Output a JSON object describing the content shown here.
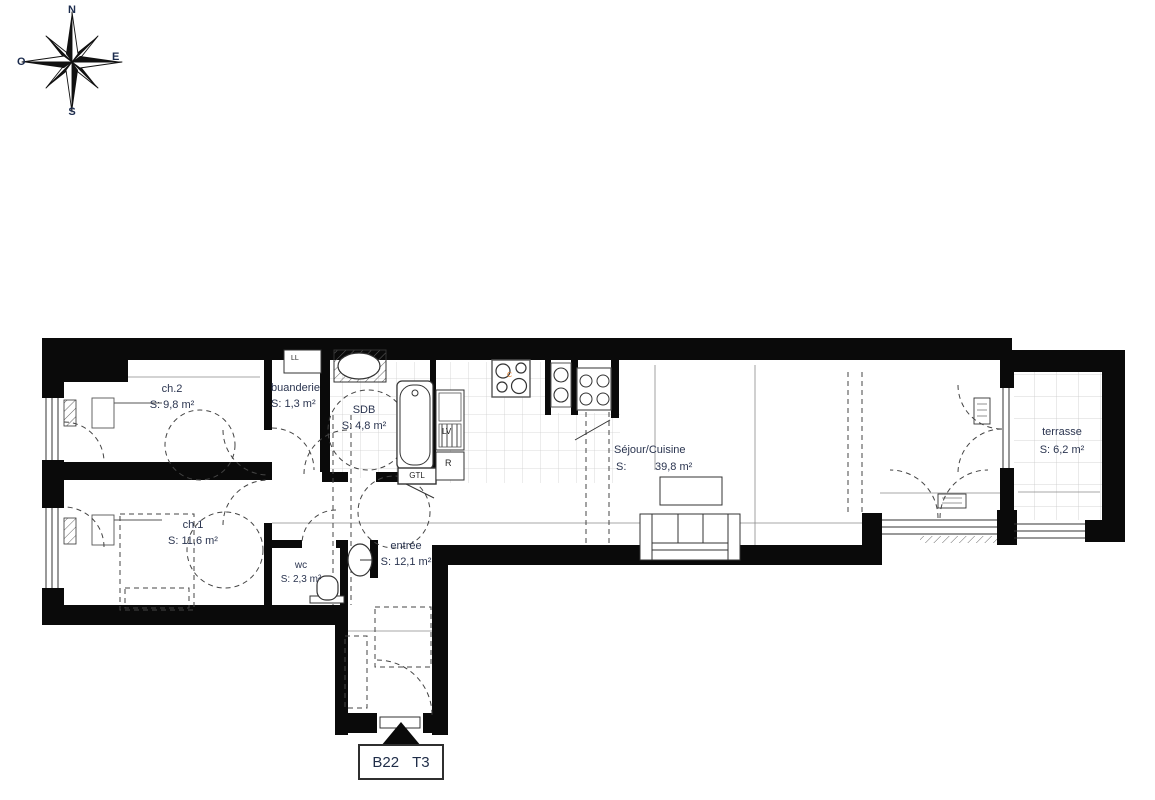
{
  "compass": {
    "north": "N",
    "south": "S",
    "east": "E",
    "west": "O"
  },
  "rooms": {
    "ch2": {
      "name": "ch.2",
      "area": "S: 9,8 m²"
    },
    "buanderie": {
      "name": "buanderie",
      "area": "S:  1,3 m²"
    },
    "sdb": {
      "name": "SDB",
      "area": "S: 4,8 m²"
    },
    "sejour": {
      "name": "Séjour/Cuisine",
      "area_label": "S:",
      "area_value": "39,8 m²"
    },
    "terrasse": {
      "name": "terrasse",
      "area": "S: 6,2 m²"
    },
    "ch1": {
      "name": "ch.1",
      "area": "S: 11,6 m²"
    },
    "wc": {
      "name": "wc",
      "area": "S: 2,3 m²"
    },
    "entree": {
      "name": "entrée",
      "area": "S: 12,1 m²"
    }
  },
  "fixtures": {
    "washing_machine": "LL",
    "dishwasher": "LV",
    "fridge": "R",
    "technical_duct": "GTL",
    "cooktop_mark": "C"
  },
  "unit": {
    "number": "B22",
    "type": "T3"
  },
  "colors": {
    "wall": "#0a0a0a",
    "label": "#2b3550",
    "tile_line": "#c9c9c9",
    "accent": "#e07b28"
  }
}
